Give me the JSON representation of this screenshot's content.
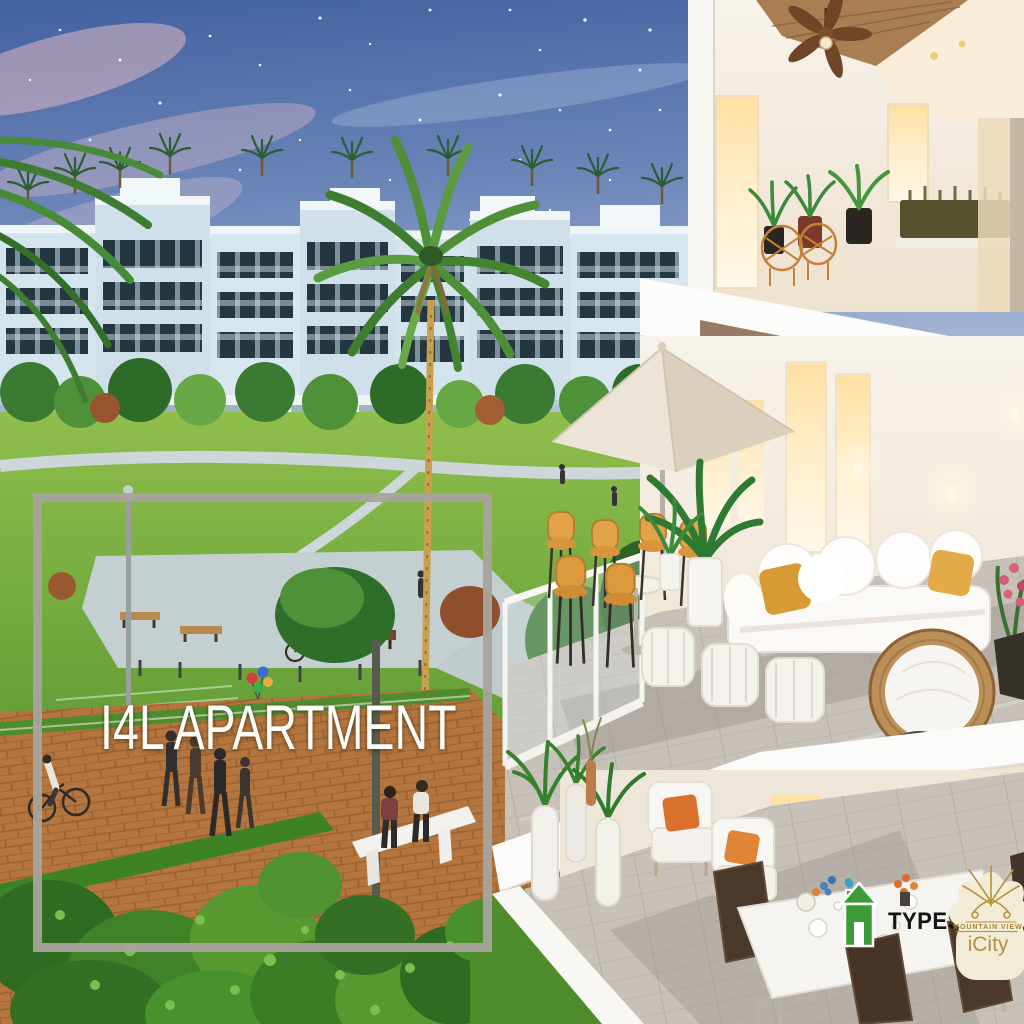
{
  "overlay": {
    "title": "I4L APARTMENT",
    "frame_color": "#a8a39d"
  },
  "badges": {
    "types": {
      "label": "TYPES",
      "icon": "house-icon",
      "icon_color": "#3d9b37",
      "accent_color": "#2fa7bd"
    }
  },
  "brand": {
    "name": "MOUNTAIN VIEW",
    "product": "iCity",
    "icon": "lotus-flower-icon",
    "gold": "#ae8d3e",
    "petal": "#f2ecd6"
  },
  "scene": {
    "type": "architectural-render",
    "elements": [
      "dusk-sky-with-stars",
      "apartment-buildings",
      "rooftop-palm-trees",
      "large-palm-tree",
      "landscaped-park",
      "plaza-benches",
      "bicycle",
      "balloons",
      "cyclist",
      "pedestrians",
      "park-bench-couple",
      "brick-promenade",
      "balcony-cutaway",
      "ceiling-fan",
      "patio-umbrella",
      "bar-chairs",
      "outdoor-sofa",
      "floor-poufs",
      "papasan-chair",
      "dining-set",
      "planter-vases"
    ],
    "colors": {
      "sky_top": "#41619f",
      "sky_horizon": "#c3cde0",
      "grass": "#79b243",
      "path_terracotta": "#b4753e",
      "accent_orange": "#dd9a3c",
      "building_white": "#f6f1ea"
    }
  }
}
